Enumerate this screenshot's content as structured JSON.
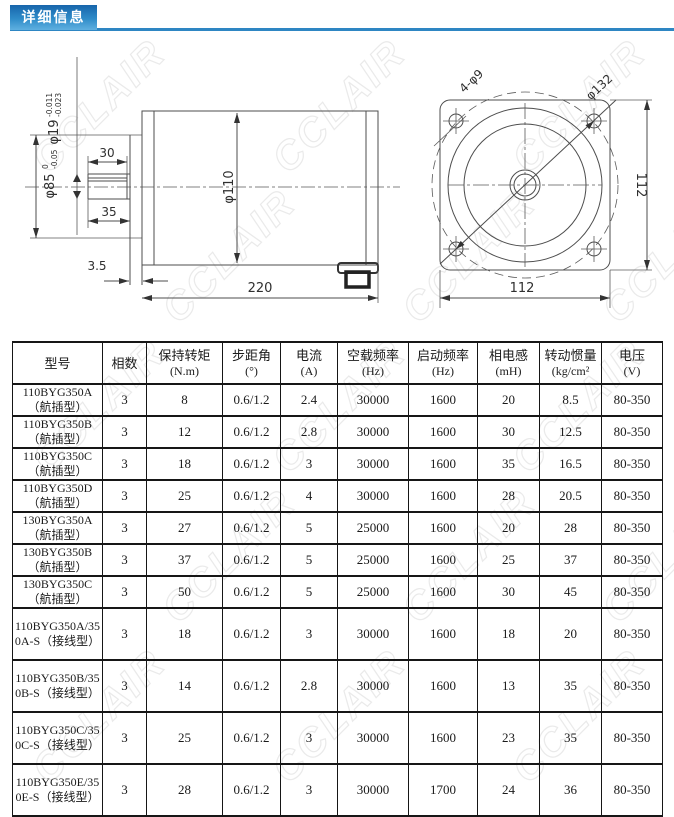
{
  "page": {
    "title_badge": "详细信息"
  },
  "watermark": {
    "text": "CCLAIR"
  },
  "colors": {
    "accent_blue": "#2e86c3",
    "badge_gradient_top": "#1765ab",
    "badge_gradient_bottom": "#5fb0e0",
    "drawing_line": "#4d4d4d",
    "table_border": "#161616"
  },
  "drawing": {
    "side_view": {
      "shaft_diameter": "φ19",
      "shaft_diameter_tol_upper": "-0.011",
      "shaft_diameter_tol_lower": "-0.023",
      "pilot_diameter": "φ85",
      "pilot_tol_upper": "0",
      "pilot_tol_lower": "-0.05",
      "key_length": "30",
      "shaft_length": "35",
      "body_diameter": "φ110",
      "body_length": "220",
      "pilot_thickness": "3.5"
    },
    "front_view": {
      "mounting_holes": "4-φ9",
      "bolt_circle_diameter": "φ132",
      "flange_width": "112",
      "flange_height": "112"
    }
  },
  "table": {
    "columns": [
      {
        "label": "型号",
        "unit": ""
      },
      {
        "label": "相数",
        "unit": ""
      },
      {
        "label": "保持转矩",
        "unit": "(N.m)"
      },
      {
        "label": "步距角",
        "unit": "(°)"
      },
      {
        "label": "电流",
        "unit": "(A)"
      },
      {
        "label": "空载频率",
        "unit": "(Hz)"
      },
      {
        "label": "启动频率",
        "unit": "(Hz)"
      },
      {
        "label": "相电感",
        "unit": "(mH)"
      },
      {
        "label": "转动惯量",
        "unit": "(kg/cm²"
      },
      {
        "label": "电压",
        "unit": "(V)"
      }
    ],
    "rows": [
      [
        "110BYG350A（航插型）",
        "3",
        "8",
        "0.6/1.2",
        "2.4",
        "30000",
        "1600",
        "20",
        "8.5",
        "80-350"
      ],
      [
        "110BYG350B（航插型）",
        "3",
        "12",
        "0.6/1.2",
        "2.8",
        "30000",
        "1600",
        "30",
        "12.5",
        "80-350"
      ],
      [
        "110BYG350C（航插型）",
        "3",
        "18",
        "0.6/1.2",
        "3",
        "30000",
        "1600",
        "35",
        "16.5",
        "80-350"
      ],
      [
        "110BYG350D（航插型）",
        "3",
        "25",
        "0.6/1.2",
        "4",
        "30000",
        "1600",
        "28",
        "20.5",
        "80-350"
      ],
      [
        "130BYG350A（航插型）",
        "3",
        "27",
        "0.6/1.2",
        "5",
        "25000",
        "1600",
        "20",
        "28",
        "80-350"
      ],
      [
        "130BYG350B（航插型）",
        "3",
        "37",
        "0.6/1.2",
        "5",
        "25000",
        "1600",
        "25",
        "37",
        "80-350"
      ],
      [
        "130BYG350C（航插型）",
        "3",
        "50",
        "0.6/1.2",
        "5",
        "25000",
        "1600",
        "30",
        "45",
        "80-350"
      ],
      [
        "110BYG350A/350A-S（接线型）",
        "3",
        "18",
        "0.6/1.2",
        "3",
        "30000",
        "1600",
        "18",
        "20",
        "80-350"
      ],
      [
        "110BYG350B/350B-S（接线型）",
        "3",
        "14",
        "0.6/1.2",
        "2.8",
        "30000",
        "1600",
        "13",
        "35",
        "80-350"
      ],
      [
        "110BYG350C/350C-S（接线型）",
        "3",
        "25",
        "0.6/1.2",
        "3",
        "30000",
        "1600",
        "23",
        "35",
        "80-350"
      ],
      [
        "110BYG350E/350E-S（接线型）",
        "3",
        "28",
        "0.6/1.2",
        "3",
        "30000",
        "1700",
        "24",
        "36",
        "80-350"
      ]
    ]
  }
}
